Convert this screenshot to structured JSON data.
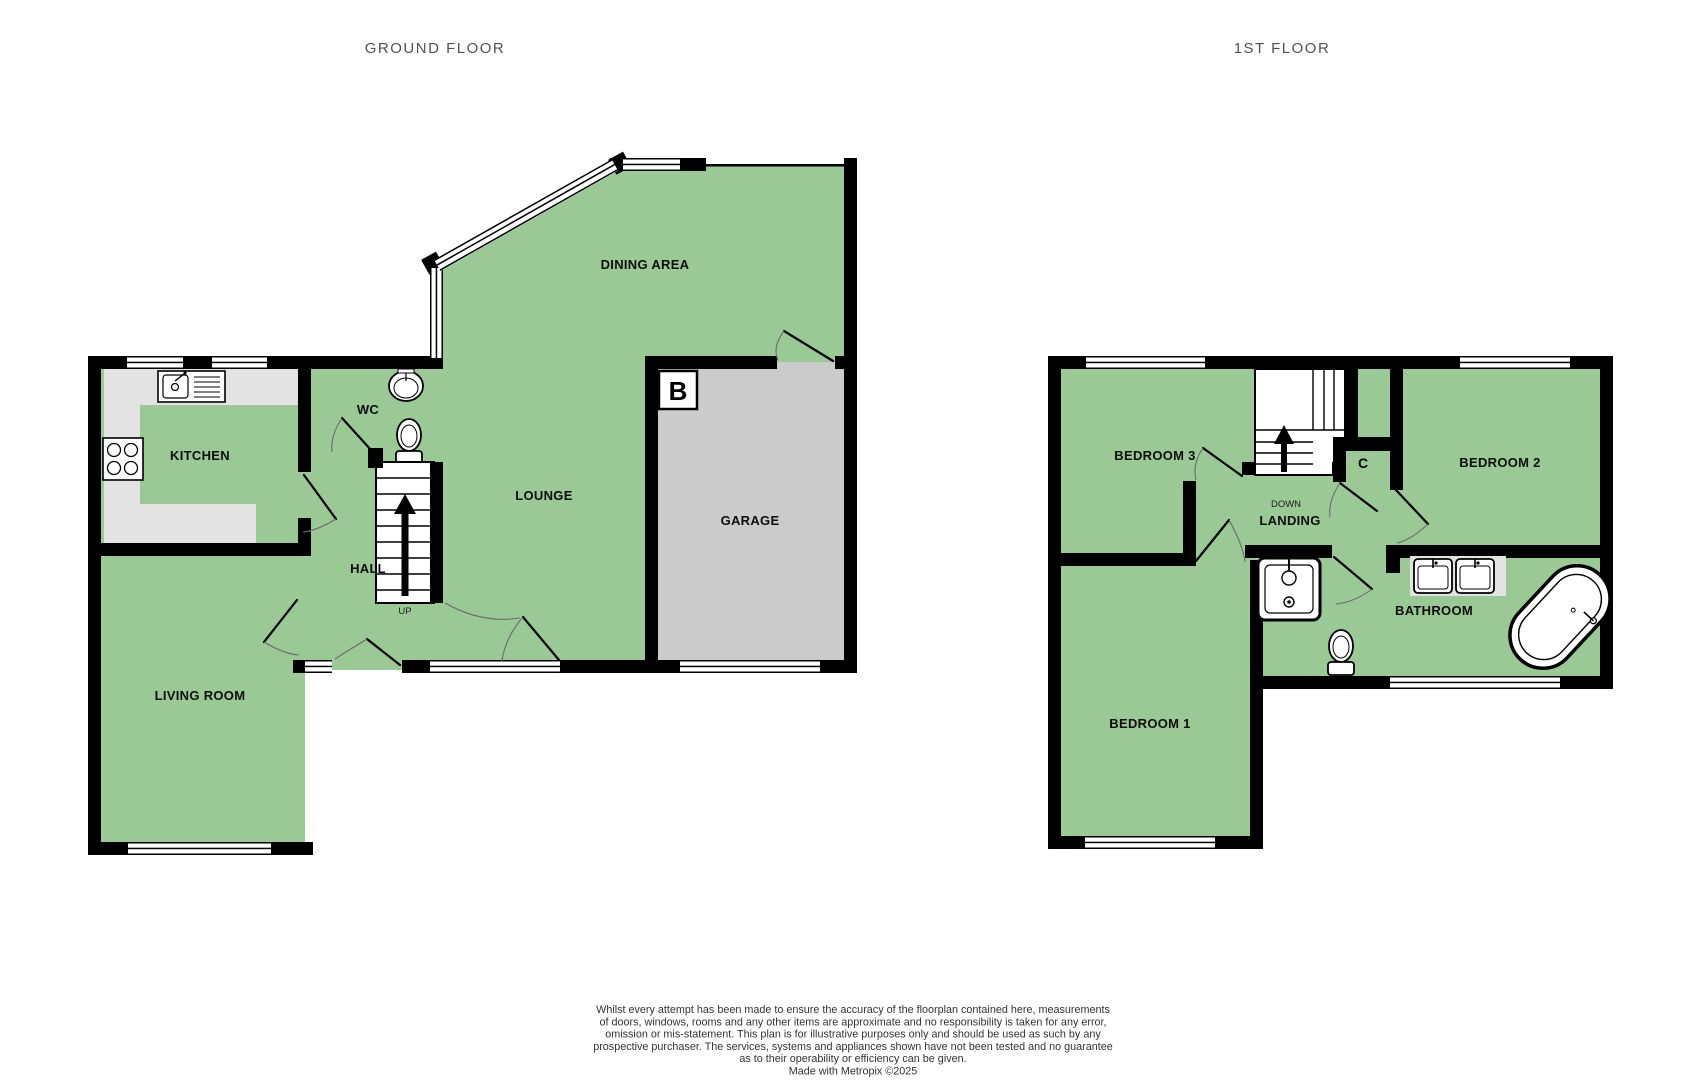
{
  "titles": {
    "ground": "GROUND FLOOR",
    "first": "1ST FLOOR"
  },
  "ground_floor": {
    "rooms": {
      "dining": "DINING AREA",
      "kitchen": "KITCHEN",
      "wc": "WC",
      "lounge": "LOUNGE",
      "garage": "GARAGE",
      "hall": "HALL",
      "living": "LIVING ROOM"
    },
    "stairs_label": "UP",
    "boiler_label": "B"
  },
  "first_floor": {
    "rooms": {
      "bedroom3": "BEDROOM 3",
      "bedroom2": "BEDROOM 2",
      "bedroom1": "BEDROOM 1",
      "landing": "LANDING",
      "bathroom": "BATHROOM"
    },
    "cupboard_label": "C",
    "stairs_label": "DOWN"
  },
  "disclaimer": {
    "lines": [
      "Whilst every attempt has been made to ensure the accuracy of the floorplan contained here, measurements",
      "of doors, windows, rooms and any other items are approximate and no responsibility is taken for any error,",
      "omission or mis-statement. This plan is for illustrative purposes only and should be used as such by any",
      "prospective purchaser. The services, systems and appliances shown have not been tested and no guarantee",
      "as to their operability or efficiency can be given.",
      "Made with Metropix ©2025"
    ]
  },
  "colors": {
    "room_green": "#9ac996",
    "garage_gray": "#cbcbcb",
    "counter_gray": "#e3e3e3",
    "wall_black": "#000000",
    "title_gray": "#525252",
    "disclaimer_gray": "#333333",
    "fixture_white": "#ffffff"
  }
}
